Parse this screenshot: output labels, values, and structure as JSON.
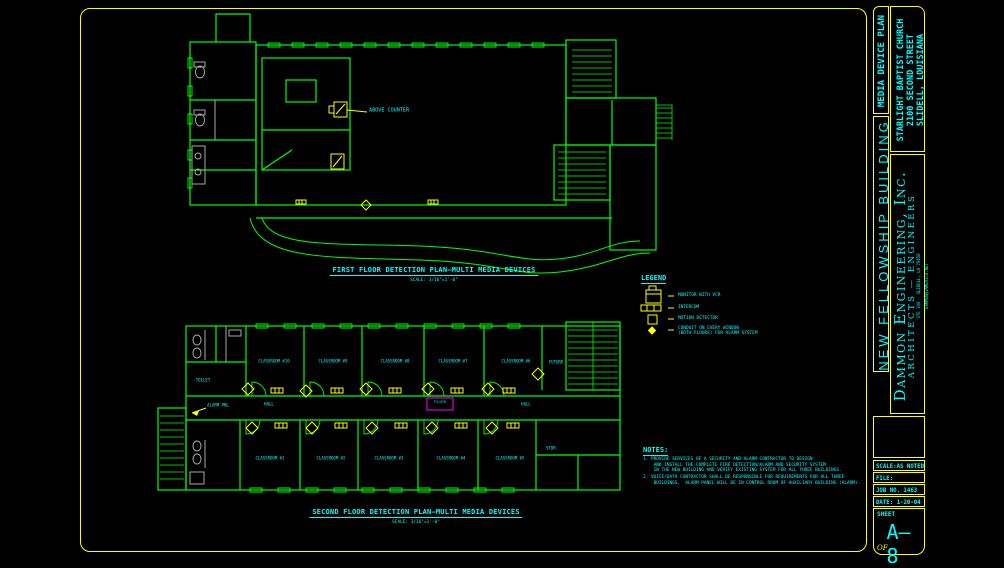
{
  "colors": {
    "background": "#000000",
    "sheet_line": "#ffff00",
    "wall_line": "#00ff00",
    "text": "#00ffff",
    "fixtures": "#a9a9a9",
    "highlight": "#ff00ff"
  },
  "title_block": {
    "plan_type": "MEDIA DEVICE PLAN",
    "project_line1": "STARLIGHT BAPTIST CHURCH",
    "project_line2": "2100 SECOND STREET",
    "project_line3": "SLIDELL, LOUISIANA",
    "building": "NEW FELLOWSHIP BUILDING",
    "firm_name": "Dammon Engineering, Inc.",
    "firm_subtitle": "ARCHITECTS — ENGINEERS",
    "firm_address1": "STE 100 · SLIDELL, LA 70458",
    "firm_address2": "DAMMON@IAMERICA.NET",
    "scale": "SCALE:AS NOTED",
    "file": "FILE:",
    "job": "JOB NO. 1463",
    "date": "DATE: 1-20-04",
    "sheet_label": "SHEET",
    "sheet_number": "A—8",
    "of_label": "OF"
  },
  "legend": {
    "title": "LEGEND",
    "monitor_label": "MONITOR WITH VCR",
    "intercom_label": "INTERCOM",
    "motion_label": "MOTION DETECTOR",
    "conduit_label1": "CONDUIT ON EVERY WINDOW",
    "conduit_label2": "(BOTH FLOORS) FOR ALARM SYSTEM"
  },
  "first_floor": {
    "title": "FIRST FLOOR DETECTION PLAN—MULTI MEDIA DEVICES",
    "scale": "SCALE: 3/16\"=1'-0\"",
    "above_counter": "ABOVE COUNTER"
  },
  "second_floor": {
    "title": "SECOND FLOOR DETECTION PLAN—MULTI MEDIA DEVICES",
    "scale": "SCALE: 3/16\"=1'-0\"",
    "rooms_top": [
      "CLASSROOM #10",
      "CLASSROOM #9",
      "CLASSROOM #8",
      "CLASSROOM #7",
      "CLASSROOM #6"
    ],
    "future_room": "FUTURE",
    "rooms_bottom": [
      "CLASSROOM #1",
      "CLASSROOM #2",
      "CLASSROOM #3",
      "CLASSROOM #4",
      "CLASSROOM #5"
    ],
    "hall_label": "HALL",
    "alarm_panel_label": "ALARM PNL",
    "tv_vcr_label": "TV/VCR",
    "toilet_label": "TOILET",
    "storage_label": "STOR."
  },
  "notes": {
    "title": "NOTES:",
    "lines": [
      "1. PROVIDE SERVICES OF A SECURITY AND ALARM CONTRACTOR TO DESIGN",
      "    AND INSTALL THE COMPLETE FIRE DETECTION/ALARM AND SECURITY SYSTEM",
      "    IN THE NEW BUILDING AND VERIFY EXISTING SYSTEM FOR ALL THREE BUILDINGS.",
      "2. VOICE/DATA CONTRACTOR SHALL BE RESPONSIBLE FOR REQUIREMENTS FOR ALL THREE",
      "    BUILDINGS.  ALARM PANEL WILL BE IN CONTROL ROOM OF AUXILIARY BUILDING (ALARM)."
    ]
  }
}
